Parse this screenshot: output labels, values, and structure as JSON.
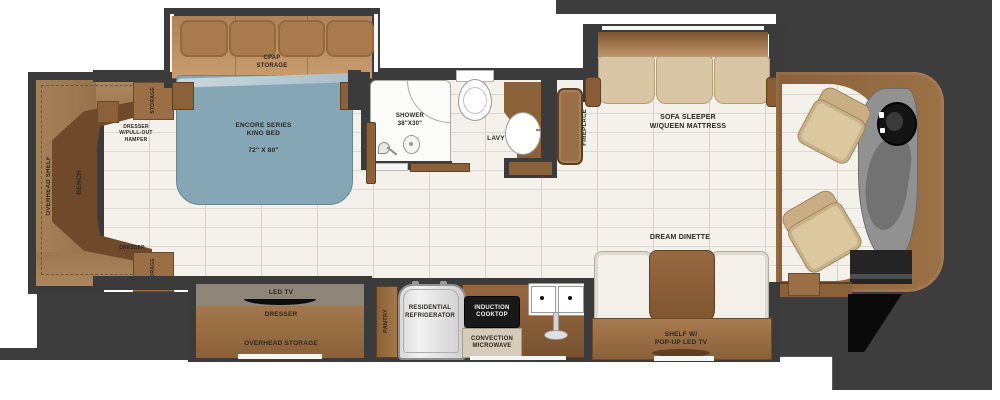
{
  "plan": {
    "title": "motorhome-floorplan",
    "bedroom": {
      "overhead_shelf": "OVERHEAD SHELF",
      "bench": "BENCH",
      "storage_top": "STORAGE",
      "storage_bottom": "STORAGE",
      "dresser_hamper": "DRESSER\nW/PULL-OUT\nHAMPER",
      "dresser_rear": "DRESSER",
      "cpap": "CPAP\nSTORAGE",
      "bed_name": "ENCORE SERIES\nKING BED",
      "bed_size": "72\" X 80\""
    },
    "bath": {
      "shower": "SHOWER\n38\"X30\"",
      "lavy": "LAVY"
    },
    "living": {
      "fireplace": "FIREPLACE",
      "sofa": "SOFA SLEEPER\nW/QUEEN MATTRESS",
      "dinette": "DREAM DINETTE",
      "shelf_tv": "SHELF W/\nPOP-UP LED TV"
    },
    "kitchen": {
      "pantry": "PANTRY",
      "refrigerator": "RESIDENTIAL\nREFRIGERATOR",
      "induction": "INDUCTION\nCOOKTOP",
      "microwave": "CONVECTION\nMICROWAVE"
    },
    "bottom_slide": {
      "led_tv": "LED TV",
      "dresser": "DRESSER",
      "overhead_storage": "OVERHEAD STORAGE"
    },
    "colors": {
      "wall": "#3b3b3b",
      "floor": "#f3f1ea",
      "cabinet_brown": "#9a7049",
      "dark_brown": "#6e4a2b",
      "bed_blue": "#85a7b5",
      "cushion_tan": "#d9c6a4"
    }
  }
}
